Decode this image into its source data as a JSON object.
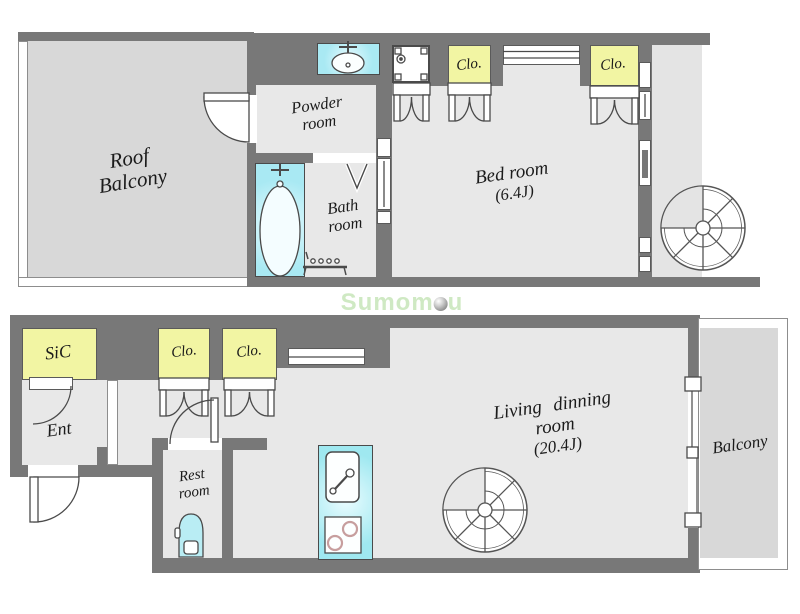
{
  "colors": {
    "wall": "#787878",
    "room_floor": "#e8e8e8",
    "balcony_floor": "#d8d8d8",
    "closet_fill": "#f2f5a3",
    "fixture_cyan": "#a9e9f3",
    "watermark_green": "#cfe9c3"
  },
  "upper_floor": {
    "roof_balcony": {
      "line1": "Roof",
      "line2": "Balcony"
    },
    "powder_room": {
      "line1": "Powder",
      "line2": "room"
    },
    "bath_room": {
      "line1": "Bath",
      "line2": "room"
    },
    "bed_room": {
      "line1": "Bed room",
      "line2": "(6.4J)"
    },
    "closet_left": "Clo.",
    "closet_right": "Clo."
  },
  "lower_floor": {
    "shoe_closet": "SiC",
    "entrance": "Ent",
    "closet_left": "Clo.",
    "closet_right": "Clo.",
    "rest_room": {
      "line1": "Rest",
      "line2": "room"
    },
    "living_dining_room": {
      "line1": "Living dinning",
      "line2": "room",
      "line3": "(20.4J)"
    },
    "balcony": "Balcony"
  },
  "watermark": {
    "prefix": "Sumom",
    "suffix": "u"
  }
}
